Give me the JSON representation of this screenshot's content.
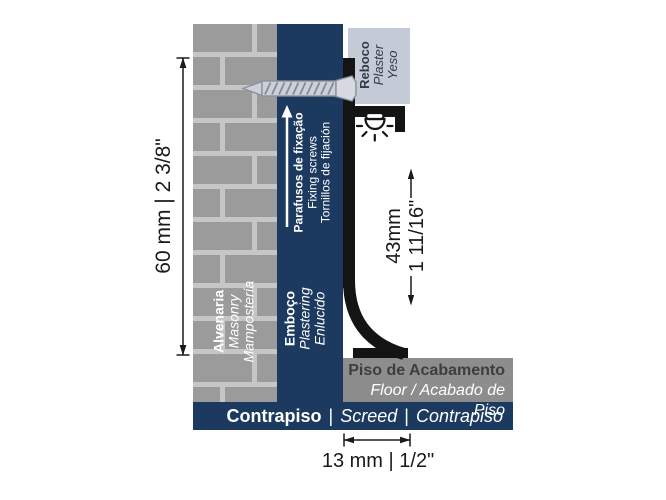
{
  "labels": {
    "wall": {
      "pt": "Alvenaria",
      "en": "Masonry",
      "es": "Mampostería"
    },
    "plastering": {
      "pt": "Emboço",
      "en": "Plastering",
      "es": "Enlucido"
    },
    "screws": {
      "pt": "Parafusos de fixação",
      "en": "Fixing screws",
      "es": "Tornillos de fijación"
    },
    "plaster": {
      "pt": "Reboco",
      "en": "Plaster",
      "es": "Yeso"
    },
    "floor": {
      "pt": "Piso de Acabamento",
      "en_es": "Floor / Acabado de Piso"
    },
    "screed": {
      "pt": "Contrapiso",
      "en": "Screed",
      "es": "Contrapiso",
      "separator": "|"
    }
  },
  "dimensions": {
    "total_height": "60 mm | 2 3/8\"",
    "exposed_height_mm": "43mm",
    "exposed_height_in": "1 11/16\"",
    "base_depth": "13 mm | 1/2\""
  },
  "icons": {
    "led": "led-light-icon",
    "screw": "fixing-screw-icon",
    "up_arrow": "up-arrow-icon"
  },
  "colors": {
    "navy": "#1c3a5f",
    "brick": "#9b9b9b",
    "mortar": "#c6c6c6",
    "plaster_box": "#c4cbd7",
    "floor_gray": "#8d8d8d",
    "profile_black": "#141414",
    "dimension": "#1a1a1a"
  }
}
